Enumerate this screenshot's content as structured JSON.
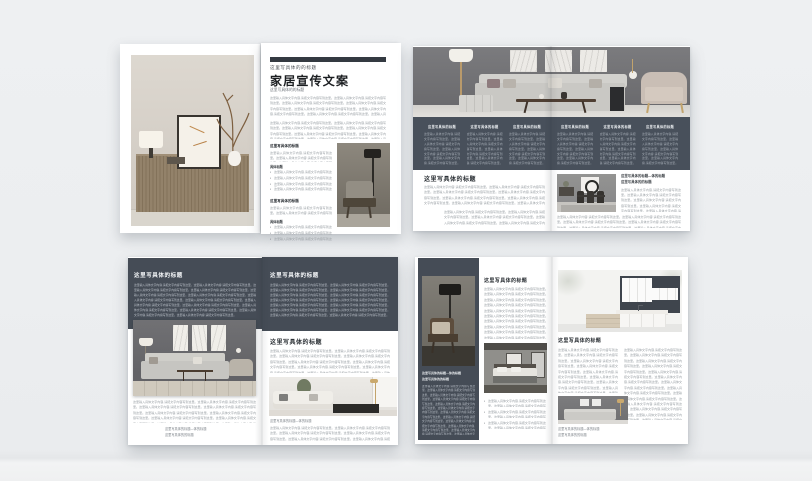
{
  "colors": {
    "backdrop": "#edeff1",
    "slate_panel": "#454c56",
    "slate_band": "#48505b",
    "title_ink": "#1b1e21",
    "body_text": "#9aa0a5",
    "body_text_on_dark": "#b9bfc7"
  },
  "placeholder": {
    "line": "这里输入具体文字内容,请把文字内容写到这里。",
    "para_short": "这里输入具体文字内容,请把文字内容写到这里。这里输入具体文字内容,请把文字内容写到这里。这里输入具体文字内容,请把文字内容写到这里。",
    "para_medium": "这里输入具体文字内容,请把文字内容写到这里。这里输入具体文字内容,请把文字内容写到这里。这里输入具体文字内容,请把文字内容写到这里。这里输入具体文字内容,请把文字内容写到这里。这里输入具体文字内容,请把文字内容写到这里。这里输入具体文字内容,请把文字内容写到这里。",
    "para_long": "这里输入具体文字内容,请把文字内容写到这里。这里输入具体文字内容,请把文字内容写到这里。这里输入具体文字内容,请把文字内容写到这里。这里输入具体文字内容,请把文字内容写到这里。这里输入具体文字内容,请把文字内容写到这里。这里输入具体文字内容,请把文字内容写到这里。这里输入具体文字内容,请把文字内容写到这里。这里输入具体文字内容,请把文字内容写到这里。这里输入具体文字内容,请把文字内容写到这里。这里输入具体文字内容,请把文字内容写到这里。这里输入具体文字内容,请把文字内容写到这里。这里输入具体文字内容,请把文字内容写到这里。这里输入具体文字内容,请把文字内容写到这里。这里输入具体文字内容,请把文字内容写到这里。"
  },
  "spread_top_left": {
    "right_page": {
      "eyebrow": "这里写具体的的标题",
      "title": "家居宣传文案",
      "subtitle": "这里写具体的的标题",
      "section1": {
        "heading": "这里写具体的标题",
        "subheading": "具体标题"
      },
      "section2": {
        "heading": "这里写具体的标题",
        "subheading": "具体标题"
      }
    }
  },
  "spread_top_right": {
    "band_columns": [
      {
        "heading": "这里写具体的标题"
      },
      {
        "heading": "这里写具体的标题"
      },
      {
        "heading": "这里写具体的标题"
      },
      {
        "heading": "这里写具体的标题"
      },
      {
        "heading": "这里写具体的标题"
      },
      {
        "heading": "这里写具体的标题"
      }
    ],
    "lower_left_heading": "这里写具体的标题",
    "lower_right": {
      "heading_line1": "这里写具体的标题—体的标题",
      "heading_line2": "这里写具体的的标题"
    }
  },
  "spread_bottom_left": {
    "left_page": {
      "band_heading": "这里写具体的标题",
      "caption_line1": "这里写具体的标题—体的标题",
      "caption_line2": "这里写具体的的标题"
    },
    "right_page": {
      "band_heading": "这里写具体的标题",
      "body_heading": "这里写具体的标题",
      "caption": "这里写具体的标题—体的标题"
    }
  },
  "spread_bottom_right": {
    "sidebar": {
      "heading_line1": "这里写具体的标题—体的标题",
      "heading_line2": "这里写具体的的标题"
    },
    "middle_heading": "这里写具体的标题",
    "right_page": {
      "heading": "这里写具体的标题",
      "caption_line1": "这里写具体的标题—体的标题",
      "caption_line2": "这里写具体的的标题"
    }
  }
}
